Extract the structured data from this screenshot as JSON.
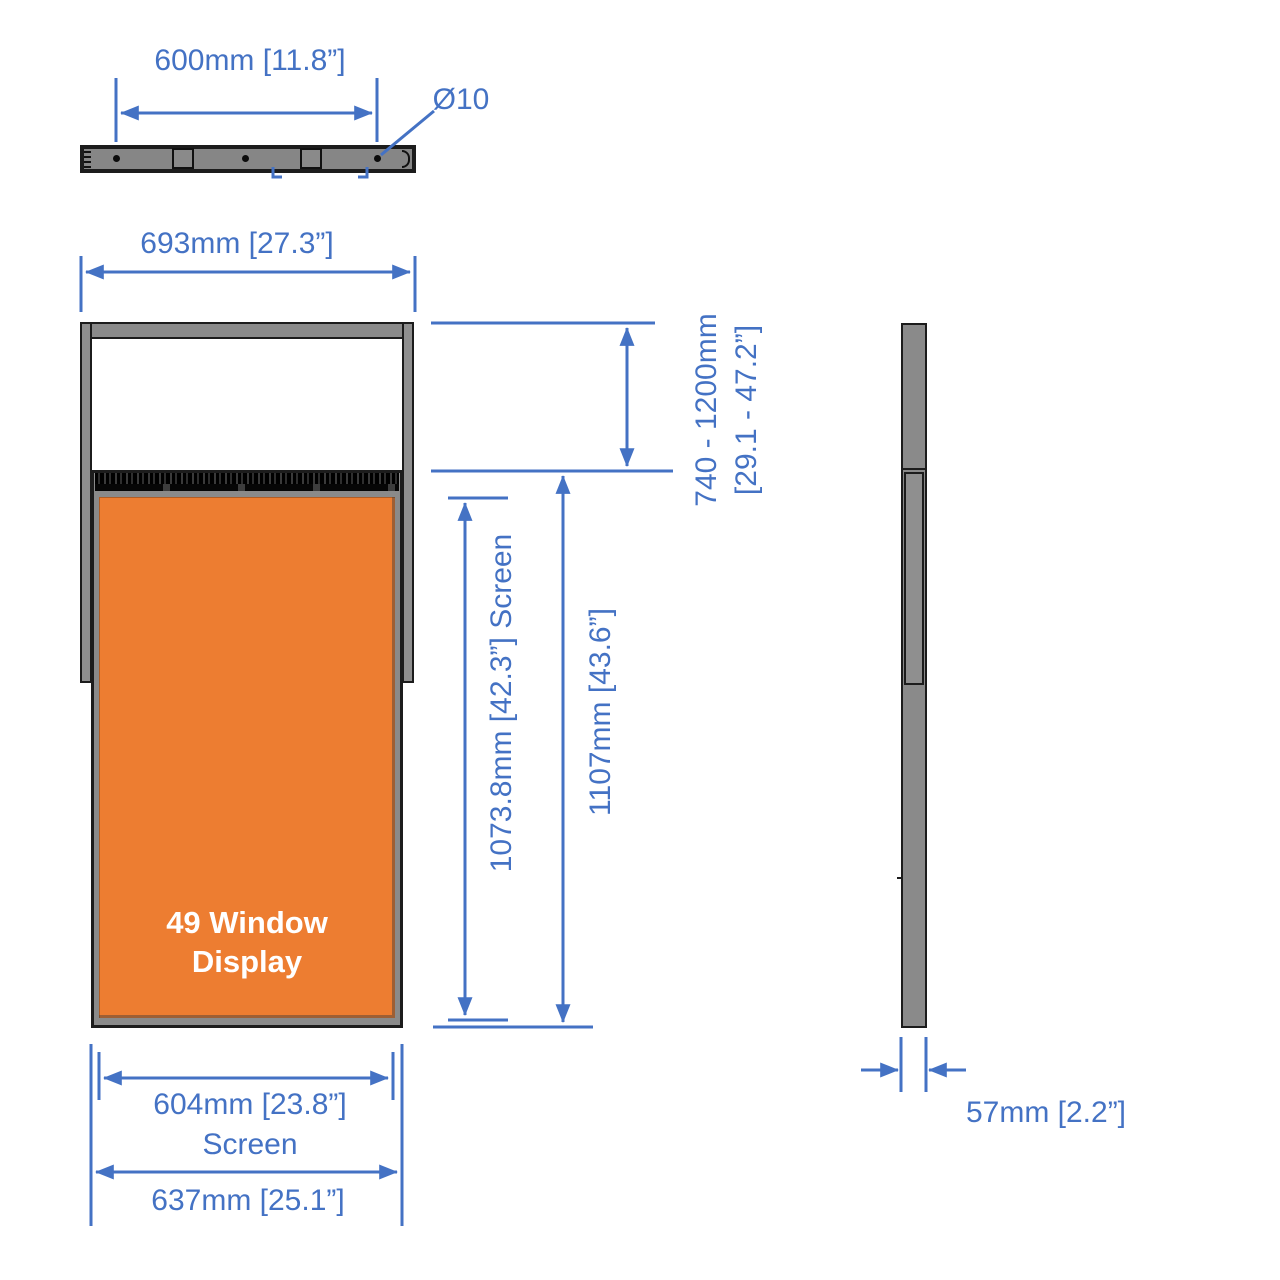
{
  "colors": {
    "accent": "#4472C4",
    "screen": "#ED7D31",
    "frame": "#8a8a8a",
    "rail": "#8f8f8f",
    "outline": "#1c1c1c",
    "vent": "#121212",
    "screen-text": "#ffffff",
    "bg": "#ffffff"
  },
  "top_view": {
    "width_label": "600mm [11.8”]",
    "hole_label": "Ø10"
  },
  "front_view": {
    "overall_width_label": "693mm [27.3”]",
    "height_range_line1": "740 - 1200mm",
    "height_range_line2": "[29.1 - 47.2”]",
    "screen_height_label": "1073.8mm [42.3”] Screen",
    "overall_height_label": "1107mm [43.6”]",
    "screen_width_label": "604mm [23.8”]",
    "screen_width_caption": "Screen",
    "bottom_width_label": "637mm [25.1”]",
    "screen_name_line1": "49 Window",
    "screen_name_line2": "Display"
  },
  "side_view": {
    "depth_label": "57mm [2.2”]"
  }
}
